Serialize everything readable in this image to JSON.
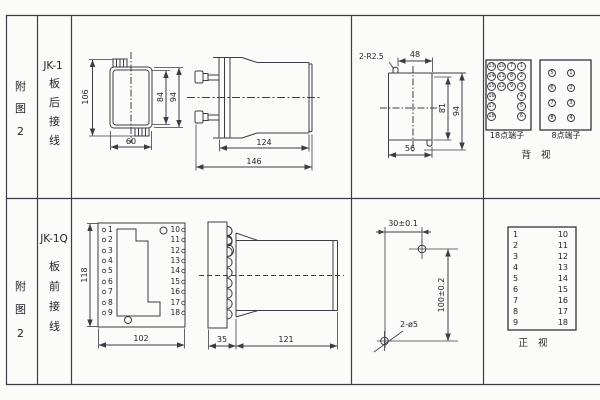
{
  "colors": {
    "ink": "#3c3c45",
    "text": "#23232b",
    "bg": "#fbfbfa"
  },
  "row1": {
    "fig": {
      "c1": "附",
      "c2": "图",
      "c3": "2"
    },
    "model": "JK-1",
    "wiring": {
      "c1": "板",
      "c2": "后",
      "c3": "接",
      "c4": "线"
    },
    "rear_view": {
      "dim_total_h": "106",
      "dim_inner_h": "84",
      "dim_outer_h": "94",
      "dim_w": "60"
    },
    "side_view": {
      "dim_body": "124",
      "dim_total": "146"
    },
    "cutout": {
      "corner": "2-R2.5",
      "dim_top": "48",
      "dim_inner_h": "81",
      "dim_outer_h": "94",
      "dim_w": "56"
    },
    "terminals": {
      "label_18": "18点端子",
      "label_8": "8点端子",
      "view_label": "背 视",
      "t18": {
        "col1": [
          "13",
          "14",
          "15",
          "16",
          "17",
          "18"
        ],
        "col2": [
          "10",
          "11",
          "12"
        ],
        "col3": [
          "7",
          "8",
          "9"
        ],
        "col4": [
          "1",
          "2",
          "3",
          "4",
          "5",
          "6"
        ]
      },
      "t8": {
        "left": [
          "5",
          "6",
          "7",
          "8"
        ],
        "right": [
          "1",
          "2",
          "3",
          "4"
        ]
      }
    }
  },
  "row2": {
    "fig": {
      "c1": "附",
      "c2": "图",
      "c3": "2"
    },
    "model": "JK-1Q",
    "wiring": {
      "c1": "板",
      "c2": "前",
      "c3": "接",
      "c4": "线"
    },
    "front_view": {
      "dim_h": "118",
      "dim_w": "102",
      "left": [
        "1",
        "2",
        "3",
        "4",
        "5",
        "6",
        "7",
        "8",
        "9"
      ],
      "right": [
        "10",
        "11",
        "12",
        "13",
        "14",
        "15",
        "16",
        "17",
        "18"
      ]
    },
    "side_view": {
      "dim_flange": "35",
      "dim_body": "121"
    },
    "drill": {
      "dim_x": "30±0.1",
      "dim_y": "100±0.2",
      "holes": "2-ø5"
    },
    "front_table": {
      "left": [
        "1",
        "2",
        "3",
        "4",
        "5",
        "6",
        "7",
        "8",
        "9"
      ],
      "right": [
        "10",
        "11",
        "12",
        "13",
        "14",
        "15",
        "16",
        "17",
        "18"
      ],
      "view_label": "正 视"
    }
  }
}
